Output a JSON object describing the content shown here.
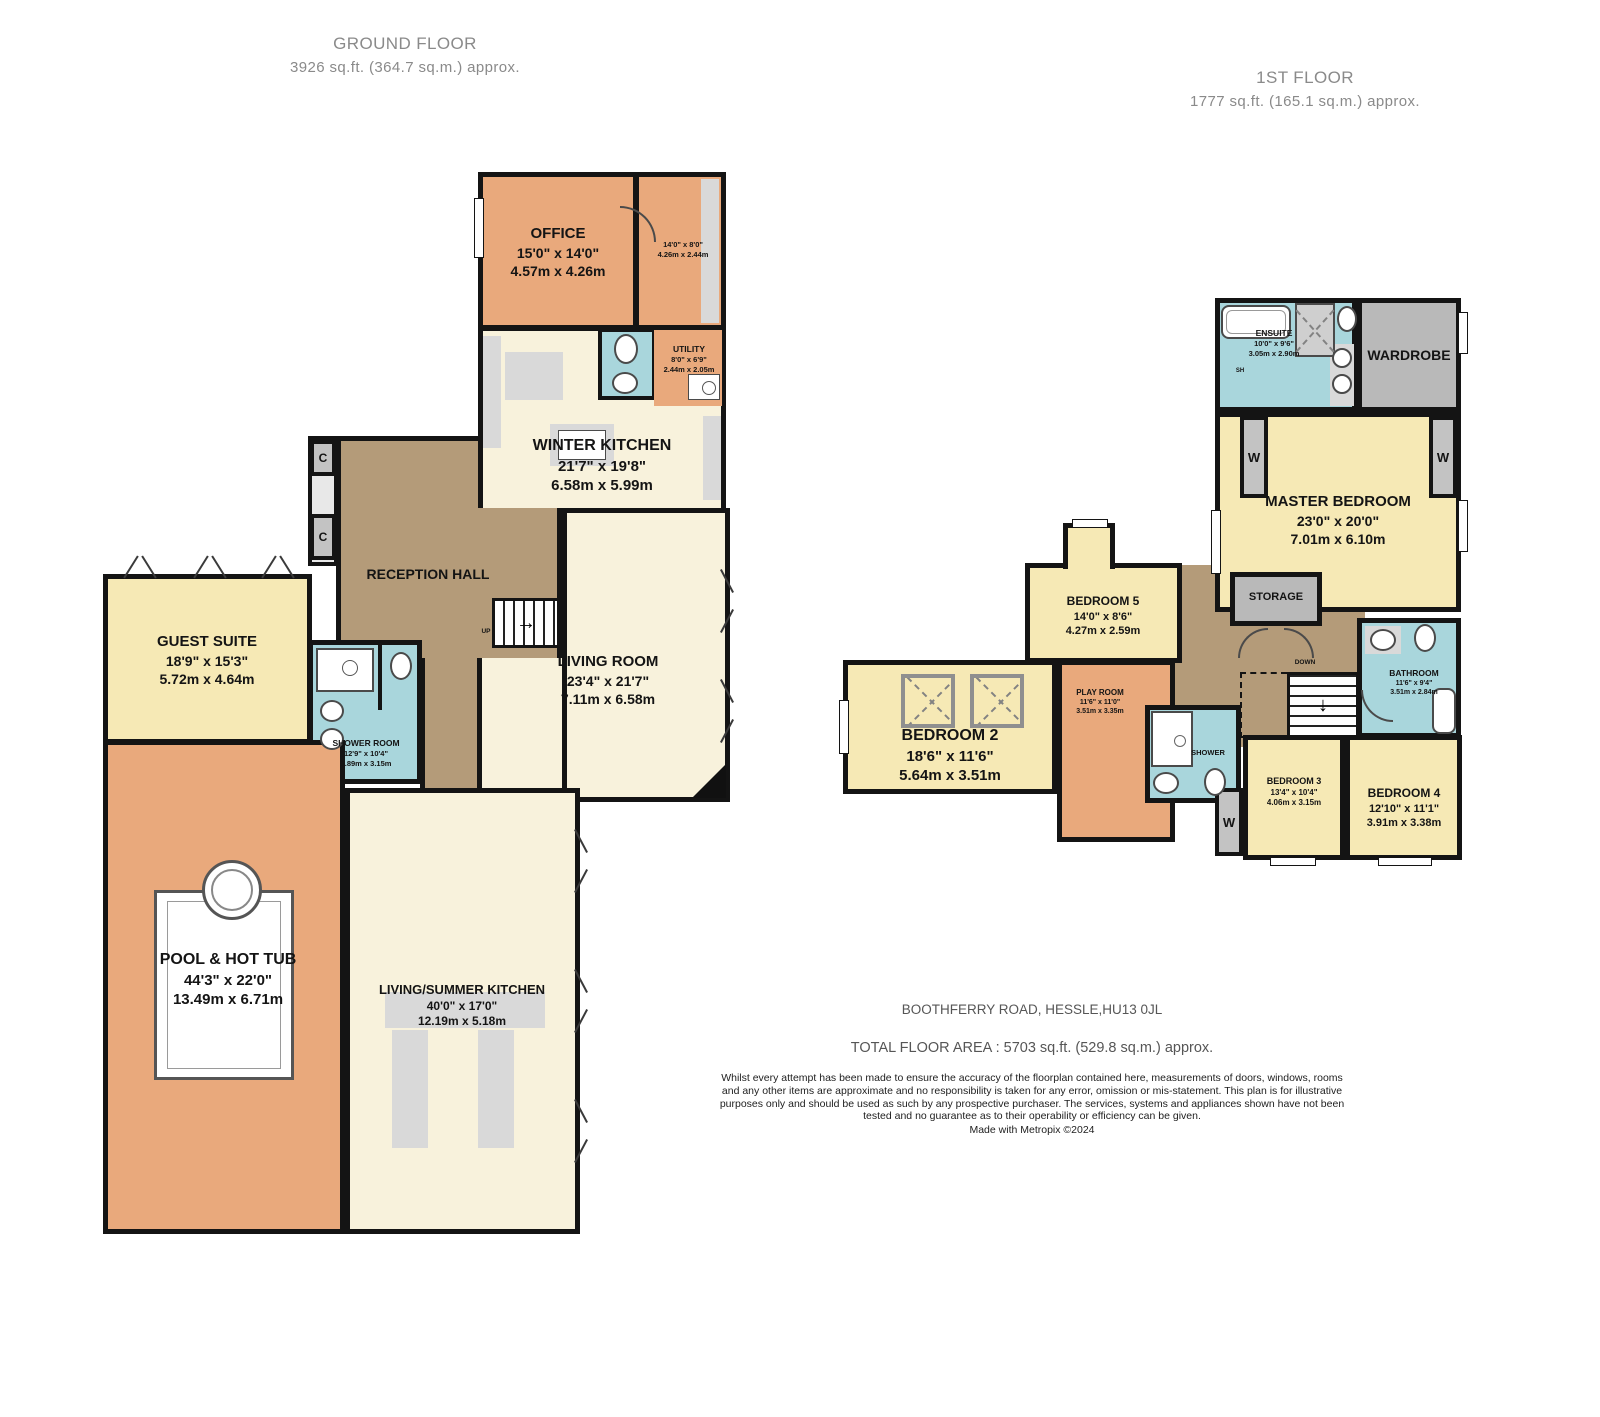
{
  "colors": {
    "room_orange": "#E9A97C",
    "room_cream": "#F8F2DC",
    "room_yellow": "#F6E9B5",
    "room_blue": "#A9D6DC",
    "hall_brown": "#B49B79",
    "closet_gray": "#BBBBBB",
    "wall_black": "#141414"
  },
  "ground": {
    "title": "GROUND FLOOR",
    "subtitle": "3926 sq.ft. (364.7 sq.m.) approx.",
    "rooms": {
      "office": {
        "name": "OFFICE",
        "imperial": "15'0\" x 14'0\"",
        "metric": "4.57m x 4.26m"
      },
      "office_annex": {
        "imperial": "14'0\" x 8'0\"",
        "metric": "4.26m x 2.44m"
      },
      "utility": {
        "name": "UTILITY",
        "imperial": "8'0\" x 6'9\"",
        "metric": "2.44m x 2.05m"
      },
      "winter_kitchen": {
        "name": "WINTER KITCHEN",
        "imperial": "21'7\" x 19'8\"",
        "metric": "6.58m x 5.99m"
      },
      "reception_hall": {
        "name": "RECEPTION HALL"
      },
      "guest_suite": {
        "name": "GUEST SUITE",
        "imperial": "18'9\" x 15'3\"",
        "metric": "5.72m x 4.64m"
      },
      "shower_room": {
        "name": "SHOWER ROOM",
        "imperial": "12'9\" x 10'4\"",
        "metric": "3.89m x 3.15m"
      },
      "living_room": {
        "name": "LIVING ROOM",
        "imperial": "23'4\" x 21'7\"",
        "metric": "7.11m x 6.58m"
      },
      "pool": {
        "name": "POOL & HOT TUB",
        "imperial": "44'3\" x 22'0\"",
        "metric": "13.49m x 6.71m"
      },
      "summer_kitchen": {
        "name": "LIVING/SUMMER KITCHEN",
        "imperial": "40'0\" x 17'0\"",
        "metric": "12.19m x 5.18m"
      }
    },
    "labels": {
      "closet": "C",
      "up": "UP"
    }
  },
  "first": {
    "title": "1ST FLOOR",
    "subtitle": "1777 sq.ft. (165.1 sq.m.) approx.",
    "rooms": {
      "ensuite": {
        "name": "ENSUITE",
        "imperial": "10'0\" x 9'6\"",
        "metric": "3.05m x 2.90m"
      },
      "wardrobe": {
        "name": "WARDROBE"
      },
      "master": {
        "name": "MASTER BEDROOM",
        "imperial": "23'0\" x 20'0\"",
        "metric": "7.01m x 6.10m"
      },
      "storage": {
        "name": "STORAGE"
      },
      "bedroom5": {
        "name": "BEDROOM 5",
        "imperial": "14'0\" x 8'6\"",
        "metric": "4.27m x 2.59m"
      },
      "bedroom2": {
        "name": "BEDROOM 2",
        "imperial": "18'6\" x 11'6\"",
        "metric": "5.64m x 3.51m"
      },
      "playroom": {
        "name": "PLAY ROOM",
        "imperial": "11'6\" x 11'0\"",
        "metric": "3.51m x 3.35m"
      },
      "shower": {
        "name": "SHOWER"
      },
      "bathroom": {
        "name": "BATHROOM",
        "imperial": "11'6\" x 9'4\"",
        "metric": "3.51m x 2.84m"
      },
      "bedroom3": {
        "name": "BEDROOM 3",
        "imperial": "13'4\" x 10'4\"",
        "metric": "4.06m x 3.15m"
      },
      "bedroom4": {
        "name": "BEDROOM 4",
        "imperial": "12'10\" x 11'1\"",
        "metric": "3.91m x 3.38m"
      }
    },
    "labels": {
      "wardrobe_short": "W",
      "shower_short": "SH",
      "down": "DOWN"
    }
  },
  "footer": {
    "address": "BOOTHFERRY ROAD, HESSLE,HU13 0JL",
    "total_area": "TOTAL FLOOR AREA : 5703 sq.ft. (529.8 sq.m.) approx.",
    "disclaimer": "Whilst every attempt has been made to ensure the accuracy of the floorplan contained here, measurements of doors, windows, rooms and any other items are approximate and no responsibility is taken for any error, omission or mis-statement. This plan is for illustrative purposes only and should be used as such by any prospective purchaser. The services, systems and appliances shown have not been tested and no guarantee as to their operability or efficiency can be given.",
    "credit": "Made with Metropix ©2024"
  }
}
